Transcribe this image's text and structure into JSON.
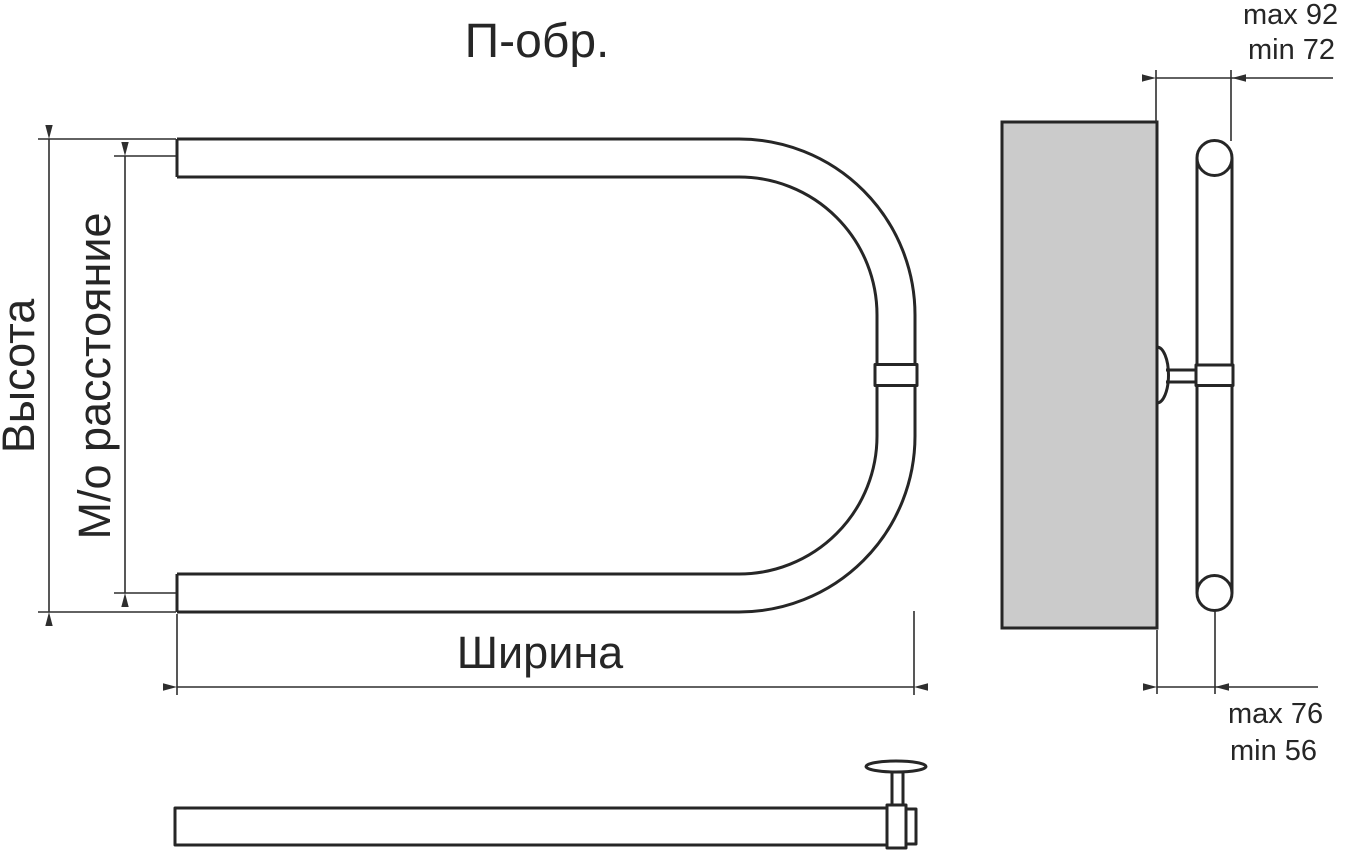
{
  "title": "П-обр.",
  "front_view": {
    "height_label": "Высота",
    "center_distance_label": "М/о расстояние",
    "width_label": "Ширина"
  },
  "side_view": {
    "top_clearance": {
      "max": "max 92",
      "min": "min 72"
    },
    "bottom_clearance": {
      "max": "max 76",
      "min": "min 56"
    }
  },
  "colors": {
    "line": "#262626",
    "dimension_line": "#2e2e2e",
    "wall_fill": "#cbcbcb",
    "background": "#ffffff"
  }
}
